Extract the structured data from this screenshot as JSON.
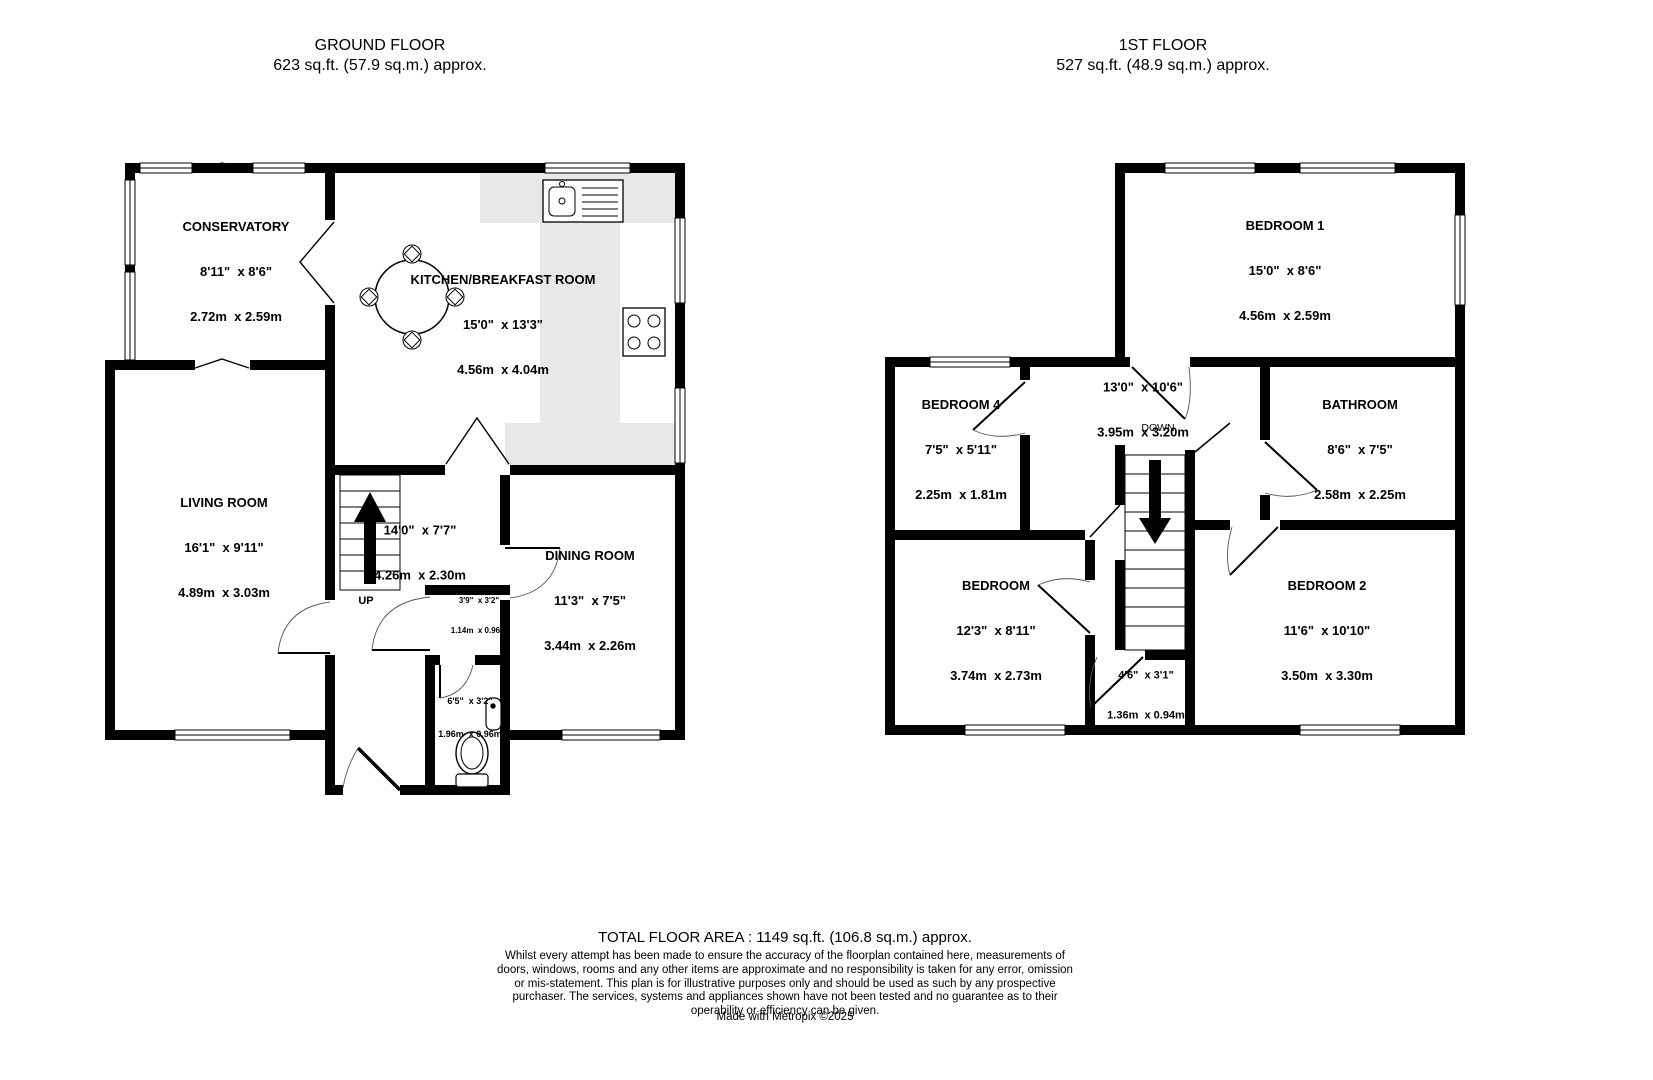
{
  "meta": {
    "background": "#ffffff",
    "wall_color": "#000000",
    "counter_color": "#e8e8e8"
  },
  "floors": [
    {
      "title": "GROUND FLOOR",
      "area_line": "623 sq.ft. (57.9 sq.m.) approx.",
      "rooms": [
        {
          "name": "CONSERVATORY",
          "imperial": "8'11\"  x 8'6\"",
          "metric": "2.72m  x 2.59m"
        },
        {
          "name": "KITCHEN/BREAKFAST ROOM",
          "imperial": "15'0\"  x 13'3\"",
          "metric": "4.56m  x 4.04m"
        },
        {
          "name": "LIVING ROOM",
          "imperial": "16'1\"  x 9'11\"",
          "metric": "4.89m  x 3.03m"
        },
        {
          "imperial": "14'0\"  x 7'7\"",
          "metric": "4.26m  x 2.30m",
          "up_label": "UP"
        },
        {
          "name": "DINING ROOM",
          "imperial": "11'3\"  x 7'5\"",
          "metric": "3.44m  x 2.26m"
        },
        {
          "imperial": "3'9\"  x 3'2\"",
          "metric": "1.14m  x 0.96m"
        },
        {
          "imperial": "6'5\"  x 3'2\"",
          "metric": "1.96m  x 0.96m"
        }
      ]
    },
    {
      "title": "1ST FLOOR",
      "area_line": "527 sq.ft. (48.9 sq.m.) approx.",
      "rooms": [
        {
          "name": "BEDROOM 1",
          "imperial": "15'0\"  x 8'6\"",
          "metric": "4.56m  x 2.59m"
        },
        {
          "name": "BEDROOM 4",
          "imperial": "7'5\"  x 5'11\"",
          "metric": "2.25m  x 1.81m"
        },
        {
          "imperial": "13'0\"  x 10'6\"",
          "metric": "3.95m  x 3.20m",
          "down_label": "DOWN"
        },
        {
          "name": "BATHROOM",
          "imperial": "8'6\"  x 7'5\"",
          "metric": "2.58m  x 2.25m"
        },
        {
          "name": "BEDROOM",
          "imperial": "12'3\"  x 8'11\"",
          "metric": "3.74m  x 2.73m"
        },
        {
          "name": "BEDROOM 2",
          "imperial": "11'6\"  x 10'10\"",
          "metric": "3.50m  x 3.30m"
        },
        {
          "imperial": "4'6\"  x 3'1\"",
          "metric": "1.36m  x 0.94m"
        }
      ]
    }
  ],
  "footer": {
    "total": "TOTAL FLOOR AREA : 1149 sq.ft. (106.8 sq.m.) approx.",
    "disclaimer": "Whilst every attempt has been made to ensure the accuracy of the floorplan contained here, measurements of doors, windows, rooms and any other items are approximate and no responsibility is taken for any error, omission or mis-statement. This plan is for illustrative purposes only and should be used as such by any prospective purchaser. The services, systems and appliances shown have not been tested and no guarantee as to their operability or efficiency can be given.",
    "credit": "Made with Metropix ©2025"
  }
}
